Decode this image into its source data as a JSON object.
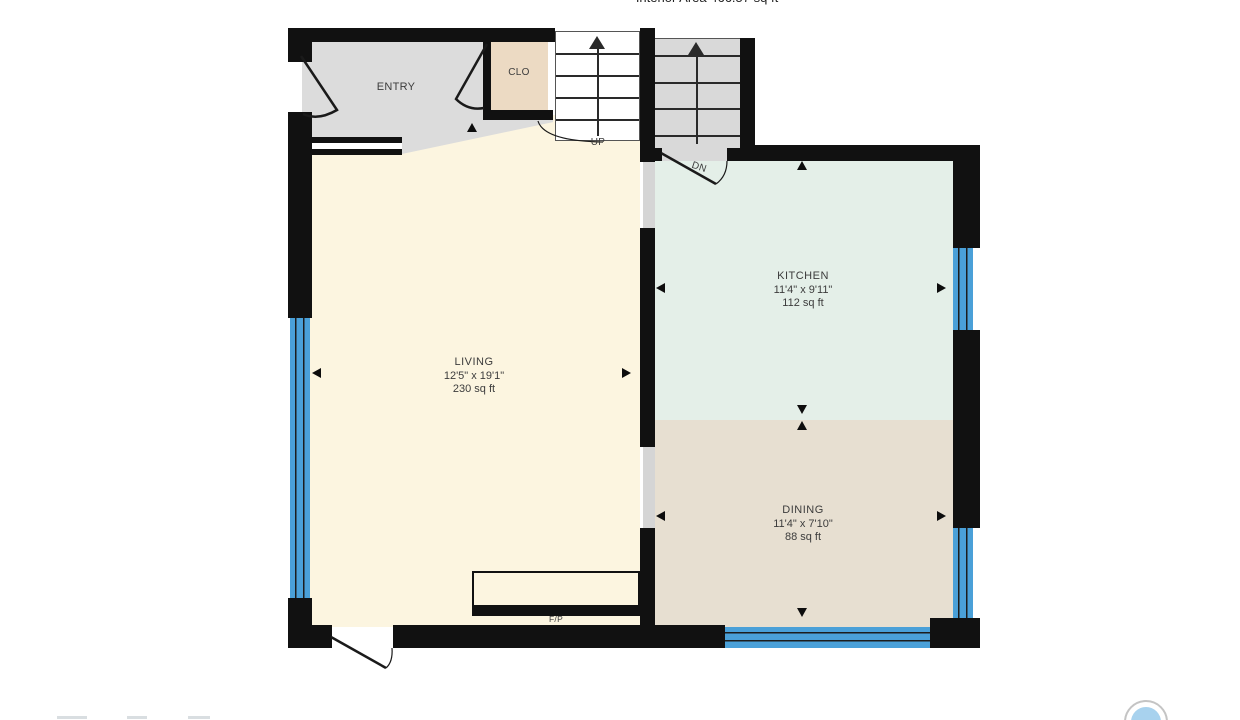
{
  "header": {
    "interior_area": "Interior Area 466.57 sq ft"
  },
  "rooms": {
    "entry": {
      "label": "ENTRY"
    },
    "closet": {
      "label": "CLO"
    },
    "living": {
      "label": "LIVING",
      "dims": "12'5\" x 19'1\"",
      "area": "230 sq ft"
    },
    "kitchen": {
      "label": "KITCHEN",
      "dims": "11'4\" x 9'11\"",
      "area": "112 sq ft"
    },
    "dining": {
      "label": "DINING",
      "dims": "11'4\" x 7'10\"",
      "area": "88 sq ft"
    }
  },
  "stairs": {
    "up": "UP",
    "down": "DN"
  },
  "fireplace": {
    "label": "F/P"
  },
  "colors": {
    "wall": "#111111",
    "entry_floor": "#dcdcdc",
    "closet_floor": "#ecdac3",
    "living_floor": "#fcf5e0",
    "kitchen_floor": "#e4efe8",
    "dining_floor": "#e7dfd1",
    "stair_floor": "#d9d9d9",
    "window_blue": "#4aa0d8",
    "label_text": "#3c3c3c",
    "logo_blue": "#a8d2ee"
  }
}
